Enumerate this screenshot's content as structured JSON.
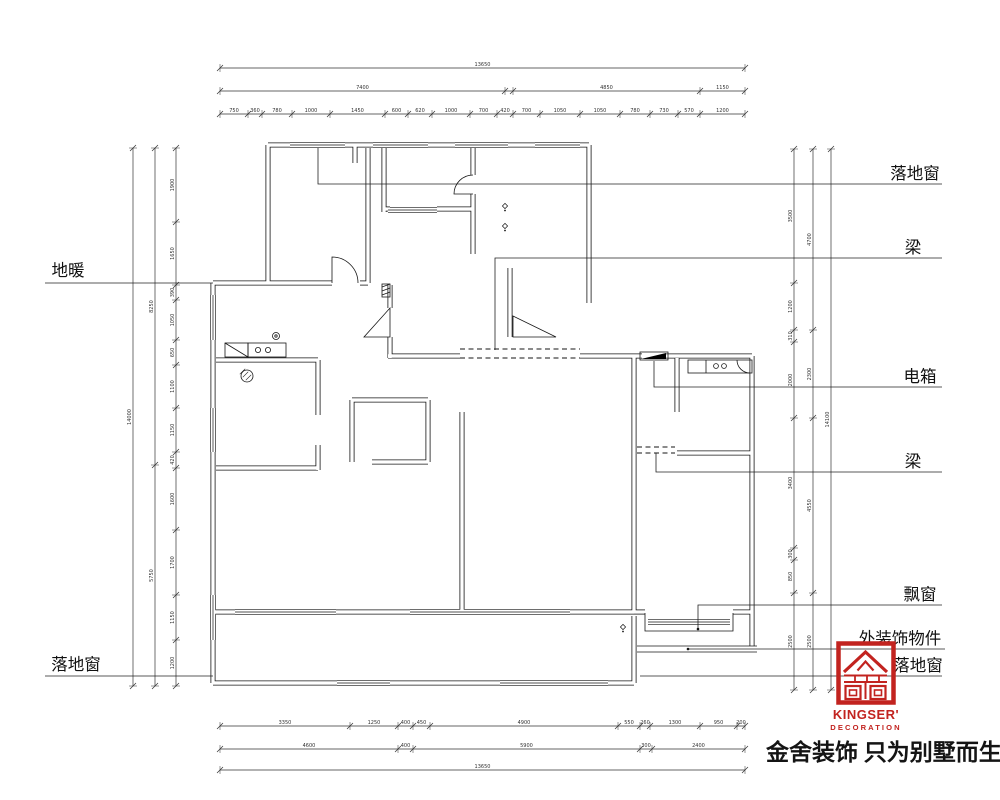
{
  "page": {
    "background": "#ffffff"
  },
  "slogan": {
    "text": "金舍装饰 只为别墅而生。"
  },
  "logo": {
    "name": "KINGSER'",
    "subtitle": "DECORATION",
    "color": "#c2231f"
  },
  "annotations": {
    "items": [
      {
        "id": "floor-window-top",
        "text": "落地窗",
        "tx": 915,
        "ty": 179,
        "line": [
          [
            318,
            148
          ],
          [
            318,
            184
          ],
          [
            942,
            184
          ]
        ]
      },
      {
        "id": "beam-upper",
        "text": "梁",
        "tx": 913,
        "ty": 253,
        "line": [
          [
            495,
            350
          ],
          [
            495,
            258
          ],
          [
            942,
            258
          ]
        ]
      },
      {
        "id": "electric-box",
        "text": "电箱",
        "tx": 920,
        "ty": 382,
        "line": [
          [
            654,
            361
          ],
          [
            654,
            387
          ],
          [
            942,
            387
          ]
        ]
      },
      {
        "id": "beam-lower",
        "text": "梁",
        "tx": 913,
        "ty": 467,
        "line": [
          [
            656,
            453
          ],
          [
            656,
            472
          ],
          [
            942,
            472
          ]
        ]
      },
      {
        "id": "bay-window",
        "text": "飘窗",
        "tx": 920,
        "ty": 600,
        "line": [
          [
            698,
            629
          ],
          [
            698,
            605
          ],
          [
            942,
            605
          ]
        ],
        "dot": [
          698,
          629
        ]
      },
      {
        "id": "exterior-ornament",
        "text": "外装饰物件",
        "tx": 900,
        "ty": 644,
        "line": [
          [
            688,
            649
          ],
          [
            945,
            649
          ]
        ],
        "dot": [
          688,
          649
        ]
      },
      {
        "id": "floor-window-bottom-right",
        "text": "落地窗",
        "tx": 918,
        "ty": 671,
        "line": [
          [
            640,
            676
          ],
          [
            942,
            676
          ]
        ]
      },
      {
        "id": "floor-heating",
        "text": "地暖",
        "tx": 68,
        "ty": 276,
        "line": [
          [
            45,
            283
          ],
          [
            213,
            283
          ]
        ]
      },
      {
        "id": "floor-window-bottom-left",
        "text": "落地窗",
        "tx": 76,
        "ty": 670,
        "line": [
          [
            45,
            676
          ],
          [
            213,
            676
          ]
        ]
      }
    ]
  },
  "dimensions": [
    {
      "orient": "h",
      "pos": 114,
      "from": 220,
      "to": 745,
      "ticks": [
        220,
        248,
        262,
        292,
        330,
        385,
        408,
        432,
        470,
        497,
        513,
        540,
        580,
        620,
        650,
        678,
        700,
        745
      ],
      "values": [
        "750",
        "360",
        "780",
        "1000",
        "1450",
        "600",
        "620",
        "1000",
        "700",
        "420",
        "700",
        "1050",
        "1050",
        "780",
        "730",
        "570",
        "1200"
      ]
    },
    {
      "orient": "h",
      "pos": 91,
      "from": 220,
      "to": 745,
      "ticks": [
        220,
        505,
        513,
        700,
        745
      ],
      "values": [
        "7400",
        "",
        "4850",
        "1150"
      ]
    },
    {
      "orient": "h",
      "pos": 68,
      "from": 220,
      "to": 745,
      "ticks": [
        220,
        745
      ],
      "values": [
        "13650"
      ]
    },
    {
      "orient": "h",
      "pos": 726,
      "from": 220,
      "to": 745,
      "ticks": [
        220,
        350,
        398,
        413,
        430,
        618,
        640,
        650,
        700,
        737,
        745
      ],
      "values": [
        "3350",
        "1250",
        "400",
        "450",
        "4900",
        "550",
        "260",
        "1300",
        "950",
        "200"
      ]
    },
    {
      "orient": "h",
      "pos": 749,
      "from": 220,
      "to": 745,
      "ticks": [
        220,
        398,
        413,
        640,
        652,
        745
      ],
      "values": [
        "4600",
        "400",
        "5900",
        "300",
        "2400"
      ]
    },
    {
      "orient": "h",
      "pos": 770,
      "from": 220,
      "to": 745,
      "ticks": [
        220,
        745
      ],
      "values": [
        "13650"
      ]
    },
    {
      "orient": "v",
      "pos": 176,
      "from": 148,
      "to": 686,
      "ticks": [
        148,
        222,
        285,
        300,
        340,
        365,
        408,
        452,
        468,
        530,
        595,
        640,
        686
      ],
      "values": [
        "1900",
        "1650",
        "390",
        "1050",
        "650",
        "1100",
        "1150",
        "420",
        "1600",
        "1700",
        "1150",
        "1200"
      ]
    },
    {
      "orient": "v",
      "pos": 155,
      "from": 148,
      "to": 686,
      "ticks": [
        148,
        465,
        686
      ],
      "values": [
        "8250",
        "5750"
      ]
    },
    {
      "orient": "v",
      "pos": 133,
      "from": 148,
      "to": 686,
      "ticks": [
        148,
        686
      ],
      "values": [
        "14000"
      ]
    },
    {
      "orient": "v",
      "pos": 794,
      "from": 149,
      "to": 690,
      "ticks": [
        149,
        283,
        330,
        342,
        418,
        548,
        560,
        593,
        690
      ],
      "values": [
        "3500",
        "1200",
        "310",
        "2000",
        "3400",
        "300",
        "850",
        "2500"
      ]
    },
    {
      "orient": "v",
      "pos": 813,
      "from": 149,
      "to": 690,
      "ticks": [
        149,
        330,
        418,
        593,
        690
      ],
      "values": [
        "4700",
        "2300",
        "4550",
        "2500"
      ]
    },
    {
      "orient": "v",
      "pos": 831,
      "from": 149,
      "to": 690,
      "ticks": [
        149,
        690
      ],
      "values": [
        "14100"
      ]
    }
  ],
  "plan": {
    "walls": [
      "M268,145 H589",
      "M268,145 V283",
      "M589,145 V303",
      "M213,283 H332",
      "M360,283 H368",
      "M368,148 V283",
      "M355,145 V163",
      "M384,148 V212",
      "M384,209 H390",
      "M437,209 H473",
      "M473,148 V175",
      "M473,194 V254",
      "M510,268 V337",
      "M390,285 V308",
      "M390,337 V358",
      "M388,356 H460",
      "M580,356 H642",
      "M666,356 H752",
      "M752,356 V646",
      "M677,453 H752",
      "M677,358 V412",
      "M634,356 V612",
      "M634,616 V683",
      "M608,612 H634",
      "M213,283 V683",
      "M213,683 H634",
      "M213,612 H235",
      "M336,612 H410",
      "M570,612 H608",
      "M216,360 H318",
      "M318,360 V415",
      "M318,445 V470",
      "M216,468 H318",
      "M352,400 H428",
      "M428,400 V462",
      "M372,462 H428",
      "M352,400 V462",
      "M462,412 V612",
      "M634,612 H645",
      "M733,612 H752"
    ],
    "windows": [
      "M213,295 V340",
      "M213,408 V452",
      "M213,595 V640",
      "M290,145 H345",
      "M373,145 H428",
      "M455,145 H508",
      "M535,145 H580",
      "M337,683 H390",
      "M500,683 H608",
      "M235,612 H336",
      "M410,612 H570",
      "M388,210 H437",
      "M648,622 H730"
    ],
    "beams": [
      "M460,349 H580",
      "M460,358 H580",
      "M637,447 H675",
      "M637,453 H675"
    ],
    "fixtures": [
      {
        "t": "rect",
        "v": [
          225,
          343,
          23,
          14
        ]
      },
      {
        "t": "line",
        "v": [
          225,
          343,
          248,
          357
        ]
      },
      {
        "t": "rect",
        "v": [
          248,
          343,
          38,
          14
        ]
      },
      {
        "t": "circle",
        "v": [
          258,
          350,
          2.6
        ]
      },
      {
        "t": "circle",
        "v": [
          268,
          350,
          2.6
        ]
      },
      {
        "t": "circle",
        "v": [
          276,
          336,
          3.5
        ]
      },
      {
        "t": "circle",
        "v": [
          276,
          336,
          1.2
        ]
      },
      {
        "t": "drain",
        "v": [
          247,
          376,
          6
        ]
      },
      {
        "t": "rect",
        "v": [
          688,
          360,
          64,
          13
        ]
      },
      {
        "t": "circle",
        "v": [
          716,
          366,
          2.4
        ]
      },
      {
        "t": "circle",
        "v": [
          724,
          366,
          2.4
        ]
      },
      {
        "t": "line",
        "v": [
          706,
          360,
          706,
          373
        ]
      },
      {
        "t": "path",
        "v": "M737,360 A13,13 0 0 0 750,373"
      },
      {
        "t": "rect",
        "v": [
          640,
          352,
          28,
          8
        ]
      },
      {
        "t": "tri",
        "v": "M641,359 L666,353 L666,359 Z"
      },
      {
        "t": "hatchrect",
        "v": [
          382,
          284,
          8,
          13
        ]
      },
      {
        "t": "path",
        "v": "M645,613 V631 H733 V613"
      },
      {
        "t": "path",
        "v": "M332,283 V257 A26,26 0 0 1 358,283"
      },
      {
        "t": "path",
        "v": "M473,194 H454 A19,19 0 0 1 473,175"
      },
      {
        "t": "path",
        "v": "M390,308 L390,337 L364,337 Z"
      },
      {
        "t": "path",
        "v": "M513,337 L556,337 L513,316 Z"
      },
      {
        "t": "line",
        "v": [
          637,
          646,
          757,
          646
        ]
      },
      {
        "t": "line",
        "v": [
          637,
          652,
          757,
          652
        ]
      }
    ],
    "symbols": [
      [
        505,
        206
      ],
      [
        505,
        226
      ],
      [
        623,
        627
      ]
    ]
  }
}
